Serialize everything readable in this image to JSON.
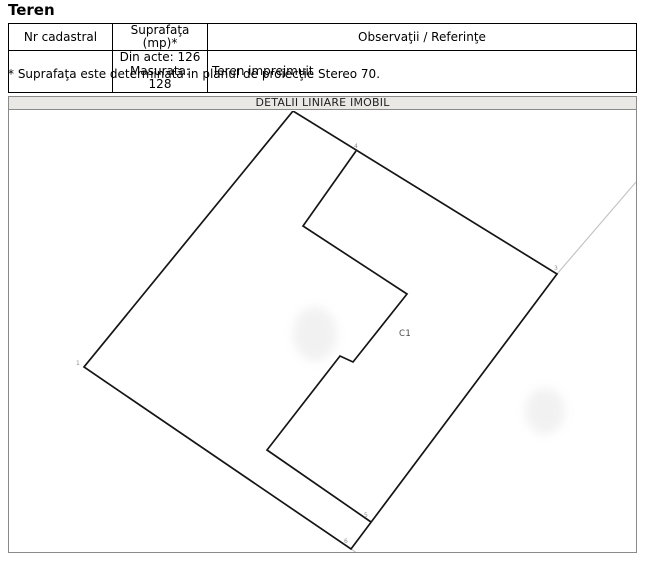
{
  "page": {
    "title": "Teren"
  },
  "table": {
    "headers": [
      "Nr cadastral",
      "Suprafaţa (mp)*",
      "Observaţii / Referinţe"
    ],
    "row": {
      "nr_cadastral": "",
      "suprafata_lines": [
        "Din acte: 126",
        "Masurata: 128"
      ],
      "observatii": "Teren imprejmuit"
    }
  },
  "note": "* Suprafaţa este determinată in planul de proiecţie Stereo 70.",
  "plan": {
    "title": "DETALII LINIARE IMOBIL",
    "building_label": {
      "text": "C1",
      "x": 399,
      "y": 335
    },
    "parcel_points": [
      [
        293,
        110
      ],
      [
        557,
        273
      ],
      [
        351,
        548
      ],
      [
        84,
        366
      ]
    ],
    "building_points": [
      [
        356,
        150
      ],
      [
        303,
        225
      ],
      [
        407,
        293
      ],
      [
        353,
        361
      ],
      [
        340,
        355
      ],
      [
        267,
        449
      ],
      [
        371,
        521
      ]
    ],
    "extension_lines": [
      {
        "from": [
          557,
          273
        ],
        "to": [
          636,
          181
        ]
      },
      {
        "from": [
          351,
          548
        ],
        "to": [
          364,
          557
        ]
      }
    ],
    "vertex_labels": [
      {
        "text": "1",
        "x": 76,
        "y": 364
      },
      {
        "text": "2",
        "x": 285,
        "y": 108
      },
      {
        "text": "3",
        "x": 554,
        "y": 269
      },
      {
        "text": "4",
        "x": 354,
        "y": 147
      },
      {
        "text": "5",
        "x": 364,
        "y": 516
      },
      {
        "text": "6",
        "x": 344,
        "y": 542
      }
    ],
    "smudges": [
      {
        "cx": 315,
        "cy": 333,
        "rx": 22,
        "ry": 27
      },
      {
        "cx": 545,
        "cy": 410,
        "rx": 20,
        "ry": 23
      }
    ]
  },
  "colors": {
    "line_black": "#151515",
    "line_gray": "#c4c4c4",
    "label_gray": "#8f8f8f",
    "building_label_color": "#4a4a4a",
    "smudge_fill": "#d2d2d2"
  }
}
